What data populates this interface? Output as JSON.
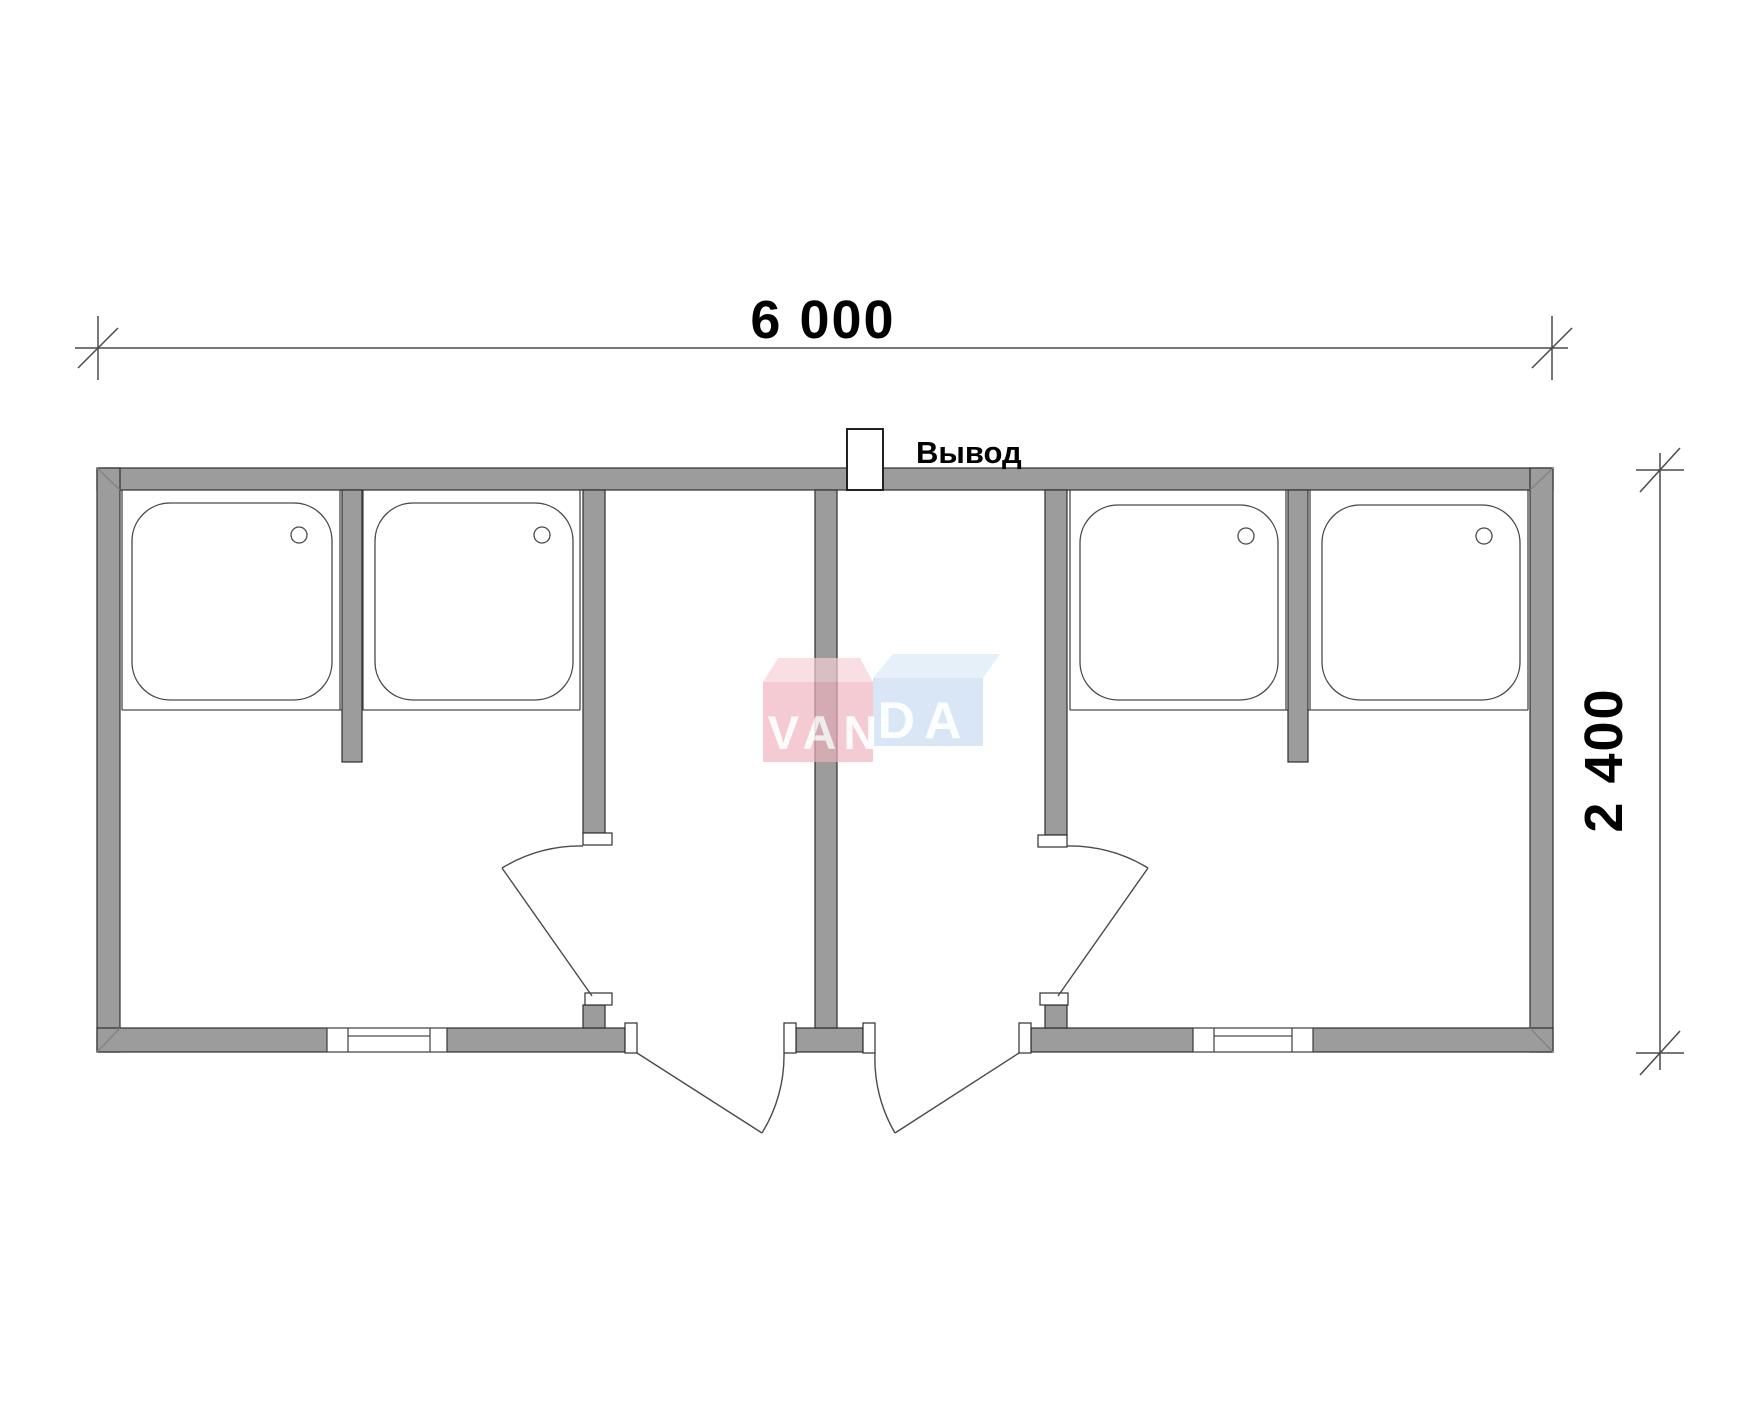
{
  "labels": {
    "width_dimension": "6 000",
    "height_dimension": "2 400",
    "outlet": "Вывод"
  },
  "logo": {
    "full": "VANDA",
    "van": "VAN",
    "da": "DA"
  },
  "colors": {
    "background": "#ffffff",
    "wall_fill": "#9c9c9c",
    "wall_stroke": "#2e2e2e",
    "line": "#4a4a4a",
    "text": "#000000",
    "jamb_fill": "#ffffff",
    "logo_pink_front": "#efb3bd",
    "logo_pink_top": "#f6d0d6",
    "logo_blue_front": "#c7dbf0",
    "logo_blue_top": "#dbe8f6",
    "logo_text": "#ffffff"
  },
  "fixtures": {
    "shower_tray_count": 4,
    "window_count": 2,
    "entrance_door_count": 2,
    "interior_door_count": 2
  }
}
